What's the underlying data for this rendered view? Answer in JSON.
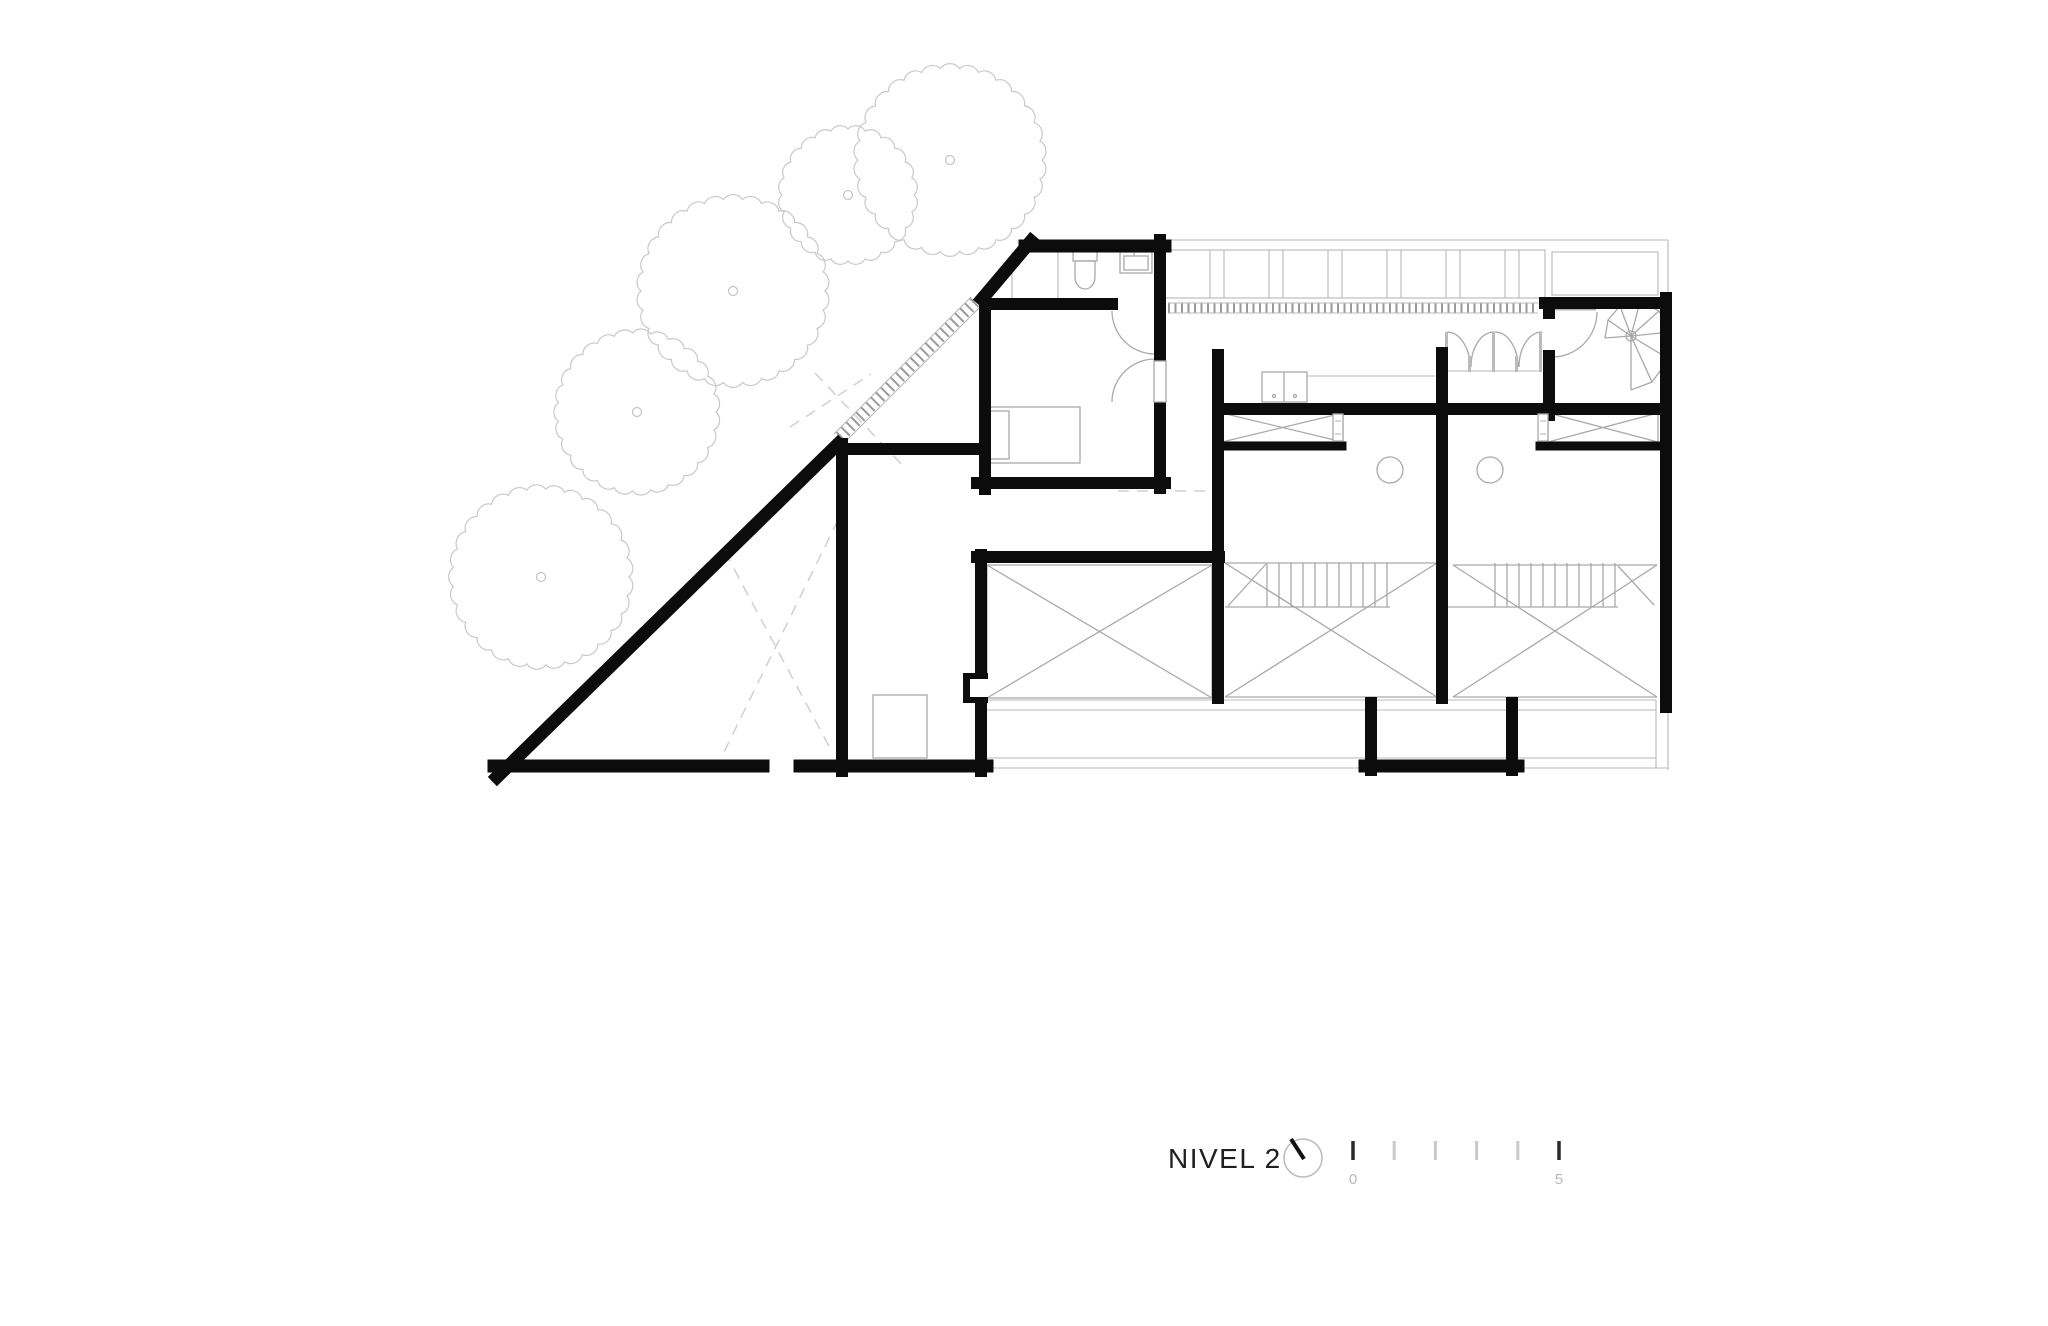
{
  "title_block": {
    "title": "NIVEL 2",
    "north_icon": "north-needle-icon",
    "scale_bar": {
      "start_label": "0",
      "end_label": "5",
      "tick_count": 6,
      "tick_start_x": 1353,
      "tick_step": 41.2,
      "tick_top": 1141,
      "tick_bottom": 1160,
      "label_y": 1184
    }
  },
  "colors": {
    "wall": "#0c0c0c",
    "thin_line": "#a9a9a9",
    "vegetation": "#c9c9c9",
    "dashed_projection": "#d0d0d0",
    "title_text": "#1f1f1f",
    "scale_muted_text": "#b9b9b9"
  },
  "plan": {
    "level_name": "NIVEL 2",
    "trees": [
      {
        "cx": 848,
        "cy": 195,
        "r": 66,
        "bumps": 24
      },
      {
        "cx": 950,
        "cy": 160,
        "r": 92,
        "bumps": 30
      },
      {
        "cx": 733,
        "cy": 291,
        "r": 92,
        "bumps": 30
      },
      {
        "cx": 637,
        "cy": 412,
        "r": 79,
        "bumps": 27
      },
      {
        "cx": 541,
        "cy": 577,
        "r": 88,
        "bumps": 29
      }
    ],
    "closet_strip": {
      "x0": 1165,
      "x1": 1545,
      "y0": 250,
      "y1": 298,
      "panel": 45,
      "gap": 14
    },
    "stairs": [
      {
        "x0": 1267,
        "count": 11,
        "step": 12,
        "y0": 563,
        "y1": 607
      },
      {
        "x0": 1495,
        "count": 11,
        "step": 12,
        "y0": 563,
        "y1": 607
      }
    ],
    "symbols": [
      "void-x-marker",
      "spiral-stair",
      "bed",
      "toilet",
      "sink",
      "wardrobe-bifold-doors",
      "ladder-hatch",
      "deck-hatch"
    ]
  }
}
